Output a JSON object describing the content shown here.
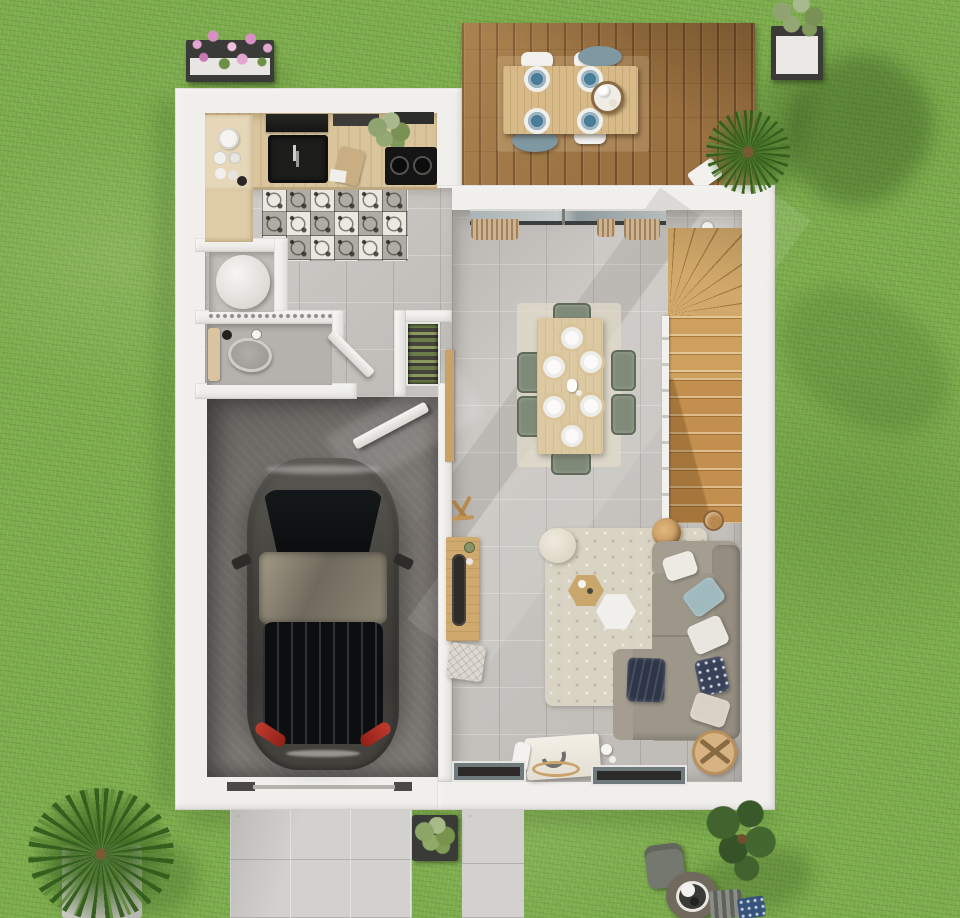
{
  "scene": {
    "description": "Top-down 3D architectural render of a single-storey house ground floor with garden, wooden deck, garage with parked car, kitchen, WC, storage, open living-dining room and winder staircase",
    "view": "top-down",
    "image_kind": "photorealistic floor plan render"
  },
  "palette": {
    "grass": "#7bab4c",
    "wall": "#f0efec",
    "tile": "#c9c6c2",
    "deck": "#9a7141",
    "wood_counter": "#d9c49c",
    "wood_cabinet": "#e6d7b8",
    "deck_table": "#d8ba88",
    "dining_table": "#dcc9a2",
    "stairs_light": "#d2a96a",
    "stairs_dark": "#c28f4e",
    "garage": "#7b7773",
    "car_body": "#46443f",
    "car_glass": "#101314",
    "taillight": "#c03a2e",
    "sofa": "#9d978a",
    "sofa_arm": "#a49d90",
    "pillow_blue": "#9fb9be",
    "pillow_navy": "#39415a",
    "blanket_navy": "#2e3547",
    "rug": "#d9d3c3",
    "chair_sage": "#7f8a78",
    "plate_blue": "#4a7d99",
    "driveway": "#d3d1cd",
    "planter_dark": "#3a3a38",
    "rattan": "#d7b282",
    "fire_pit": "#71685e",
    "teal_chair": "#7f98a2"
  },
  "exterior": {
    "lawn": "grass garden surrounding house",
    "deck": {
      "name": "wooden terrace",
      "items": [
        "outdoor-dining-table",
        "blue-plates x4",
        "white-chairs x4",
        "teal-chairs x2",
        "serving-tray",
        "potted-palm",
        "towel"
      ]
    },
    "garden_items": [
      "pink-flower-box",
      "purple-flower-planter",
      "palm-bush-on-paver",
      "leafy-tree",
      "outdoor-chair",
      "fire-pit-table",
      "striped-lounger",
      "blue-cushion",
      "square-planter",
      "driveway",
      "entry-path"
    ]
  },
  "rooms": [
    {
      "name": "kitchen",
      "floor": "cement-tile rug + wood",
      "items": [
        "black-sink",
        "faucet",
        "cooktop-2-burners",
        "range-hood",
        "dish-shelf",
        "lower-cabinet",
        "cutting-board",
        "herb-plant"
      ]
    },
    {
      "name": "hallway",
      "floor": "patterned cement tiles + grey tiles",
      "items": [
        "threshold-grille"
      ]
    },
    {
      "name": "storage-room",
      "items": [
        "water-heater-cylinder"
      ]
    },
    {
      "name": "wc",
      "items": [
        "toilet",
        "toilet-paper",
        "bin",
        "swing-door"
      ]
    },
    {
      "name": "closet",
      "items": [
        "shelves-with-linens"
      ]
    },
    {
      "name": "garage",
      "items": [
        "dark-grey-car",
        "swing-door",
        "garage-door-rails"
      ]
    },
    {
      "name": "living-dining",
      "items": [
        "sliding-glass-door",
        "curtains",
        "winder-staircase",
        "dining-table",
        "sage-chairs x6",
        "white-plates x6",
        "corner-sofa",
        "cushions",
        "hexagonal-coffee-tables",
        "fluffy-rug",
        "round-pouf",
        "floor-lamp",
        "sideboard",
        "coat-stand",
        "woven-pouf",
        "desk-with-lamp",
        "rattan-pouf",
        "windows x2",
        "wall-light"
      ]
    }
  ]
}
